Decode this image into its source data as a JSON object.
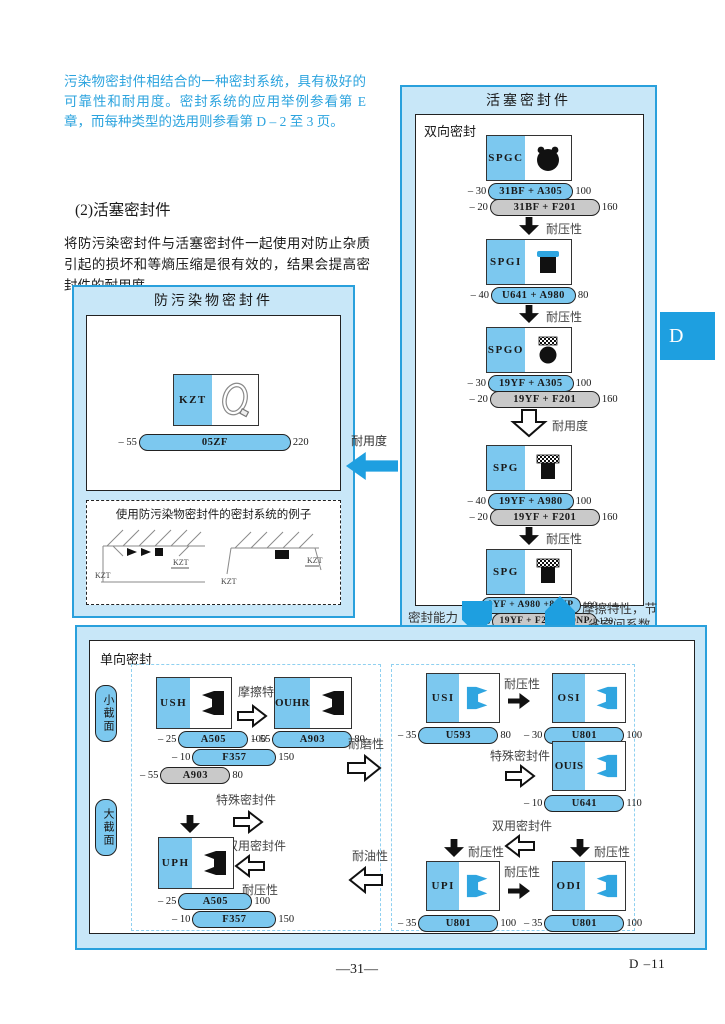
{
  "page": {
    "intro": "污染物密封件相结合的一种密封系统，具有极好的可靠性和耐用度。密封系统的应用举例参看第 E 章，而每种类型的选用则参看第 D – 2 至 3 页。",
    "section_heading": "(2)活塞密封件",
    "section_body": "将防污染密封件与活塞密封件一起使用对防止杂质引起的损坏和等熵压缩是很有效的，结果会提高密封件的耐用度。",
    "page_number": "—31—",
    "page_ref": "D –11",
    "side_tab": "D"
  },
  "contamination_box": {
    "title": "防污染物密封件",
    "seal_code": "KZT",
    "pill": {
      "low": "– 55",
      "label": "05ZF",
      "high": "220"
    },
    "example_title": "使用防污染物密封件的密封系统的例子",
    "kzt1": "KZT",
    "kzt2": "KZT",
    "kzt3": "KZT",
    "kzt4": "KZT"
  },
  "link_arrow_label": "耐用度",
  "piston_box": {
    "title": "活塞密封件",
    "subtitle": "双向密封",
    "items": [
      {
        "code": "SPGC",
        "pills": [
          {
            "low": "– 30",
            "label": "31BF + A305",
            "high": "100"
          },
          {
            "low": "– 20",
            "label": "31BF + F201",
            "high": "160"
          }
        ],
        "arrow_label": "耐压性"
      },
      {
        "code": "SPGI",
        "pills": [
          {
            "low": "– 40",
            "label": "U641 + A980",
            "high": "80"
          }
        ],
        "arrow_label": "耐压性"
      },
      {
        "code": "SPGO",
        "pills": [
          {
            "low": "– 30",
            "label": "19YF + A305",
            "high": "100"
          },
          {
            "low": "– 20",
            "label": "19YF + F201",
            "high": "160"
          }
        ],
        "arrow_label": "耐用度"
      },
      {
        "code": "SPG",
        "pills": [
          {
            "low": "– 40",
            "label": "19YF + A980",
            "high": "100"
          },
          {
            "low": "– 20",
            "label": "19YF + F201",
            "high": "160"
          }
        ],
        "arrow_label": "耐压性"
      },
      {
        "code": "SPG",
        "pills": [
          {
            "low": "– 40",
            "label": "9YF + A980 +80NP",
            "high": "100"
          },
          {
            "low": "– 20",
            "label": "19YF + F201 +80NP",
            "high": "120"
          }
        ]
      }
    ],
    "bottom_left_label": "密封能力",
    "bottom_right_label_1": "摩擦特性，节",
    "bottom_right_label_2": "省空间系数"
  },
  "rod_box": {
    "label": "单向密封",
    "small_section": "小截面",
    "large_section": "大截面",
    "left": {
      "ush_code": "USH",
      "ush_pills": [
        {
          "low": "– 25",
          "label": "A505",
          "high": "100"
        },
        {
          "low": "– 10",
          "label": "F357",
          "high": "150"
        },
        {
          "low": "– 55",
          "label": "A903",
          "high": "80"
        }
      ],
      "friction_label": "摩擦特性",
      "ouhr_code": "OUHR",
      "ouhr_pill": {
        "low": "– 55",
        "label": "A903",
        "high": "80"
      },
      "special_label": "特殊密封件",
      "dual_label": "双用密封件",
      "pressure_label": "耐压性",
      "uph_code": "UPH",
      "uph_pills": [
        {
          "low": "– 25",
          "label": "A505",
          "high": "100"
        },
        {
          "low": "– 10",
          "label": "F357",
          "high": "150"
        }
      ]
    },
    "mid": {
      "wear_label": "耐磨性",
      "oil_label": "耐油性"
    },
    "right": {
      "usi_code": "USI",
      "usi_pill": {
        "low": "– 35",
        "label": "U593",
        "high": "80"
      },
      "pressure_label_1": "耐压性",
      "osi_code": "OSI",
      "osi_pill": {
        "low": "– 30",
        "label": "U801",
        "high": "100"
      },
      "special_label": "特殊密封件",
      "ouis_code": "OUIS",
      "ouis_pill": {
        "low": "– 10",
        "label": "U641",
        "high": "110"
      },
      "dual_label": "双用密封件",
      "pressure_label_2": "耐压性",
      "pressure_label_3": "耐压性",
      "pressure_label_4": "耐压性",
      "upi_code": "UPI",
      "upi_pill": {
        "low": "– 35",
        "label": "U801",
        "high": "100"
      },
      "odi_code": "ODI",
      "odi_pill": {
        "low": "– 35",
        "label": "U801",
        "high": "100"
      }
    }
  }
}
